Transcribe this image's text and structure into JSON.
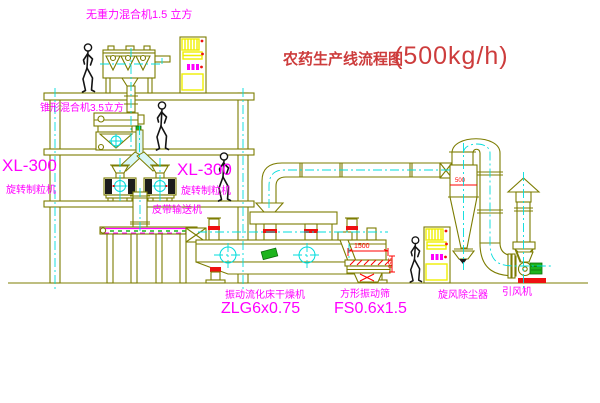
{
  "title": {
    "name": "农药生产线流程图",
    "capacity": "(500kg/h)"
  },
  "equipment_labels": {
    "top_mixer": "无重力混合机1.5 立方",
    "floor2_mixer": "锥形混合机3.5立方",
    "granulator_left_model": "XL-300",
    "granulator_left_name": "旋转制粒机",
    "granulator_right_model": "XL-300",
    "granulator_right_name": "旋转制粒机",
    "belt_conveyor": "皮带输送机",
    "dryer_name": "振动流化床干燥机",
    "dryer_model": "ZLG6x0.75",
    "sieve_name": "方形振动筛",
    "sieve_model": "FS0.6x1.5",
    "cyclone": "旋风除尘器",
    "fan": "引风机"
  },
  "dimensions": {
    "sieve_length": "1500",
    "sieve_height": "550",
    "cyclone_note": "500"
  },
  "colors": {
    "linework": "#7c7c00",
    "centerline": "#00dcdc",
    "label_magenta": "#ff00ff",
    "title_red": "#cd3c3c",
    "dimension_red": "#ff0000",
    "cabinet_yellow": "#f0f000",
    "motor_green": "#1db41d"
  }
}
